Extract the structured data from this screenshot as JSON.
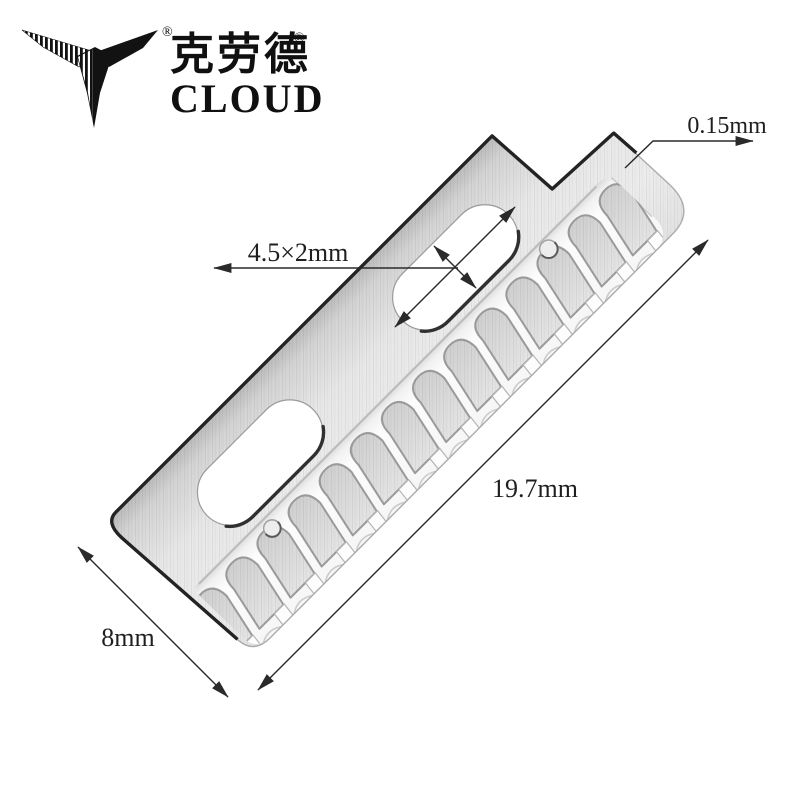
{
  "brand": {
    "icon": "bird-logo",
    "name_cn": "克劳德",
    "name_en": "CLOUD",
    "reg": "®"
  },
  "dimensions": {
    "thickness": "0.15mm",
    "hole": "4.5×2mm",
    "length": "19.7mm",
    "width": "8mm"
  },
  "blade": {
    "teeth_count": 14
  },
  "colors": {
    "background": "#ffffff",
    "steel_dark": "#bfbfbf",
    "steel_light": "#efefef",
    "tooth_gray": "#d7d7d7",
    "edge_dark": "#232323",
    "annotation": "#2a2a2a"
  }
}
